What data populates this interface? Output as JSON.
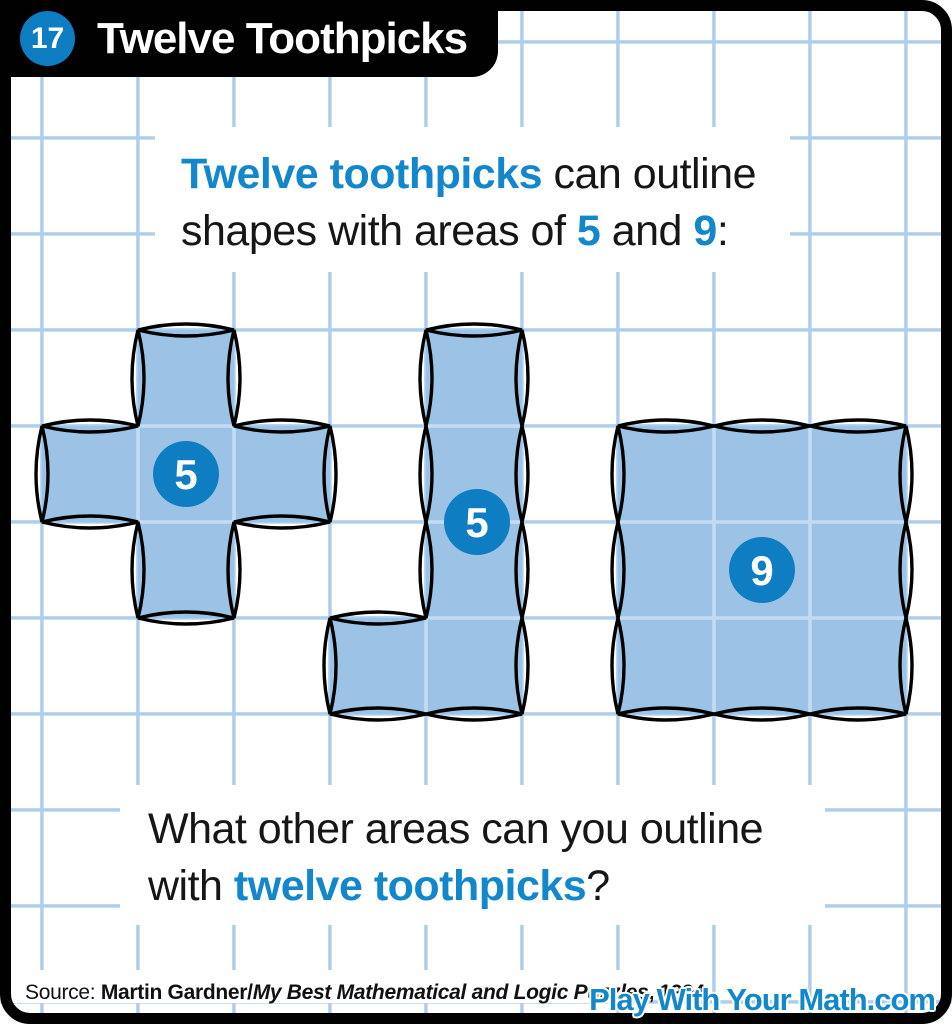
{
  "colors": {
    "accent": "#1287CB",
    "badge": "#0E7DC2",
    "shape_fill": "#9CC3E6",
    "grid_line": "#AFCEEC",
    "inner_line": "#C3DCF4",
    "frame": "#010101"
  },
  "header": {
    "number": "17",
    "title": "Twelve Toothpicks"
  },
  "intro": {
    "lines": [
      [
        {
          "text": "Twelve toothpicks",
          "style": "accent"
        },
        {
          "text": " can outline",
          "style": "plain"
        }
      ],
      [
        {
          "text": "shapes with areas of ",
          "style": "plain"
        },
        {
          "text": "5",
          "style": "accent"
        },
        {
          "text": " and ",
          "style": "plain"
        },
        {
          "text": "9",
          "style": "accent"
        },
        {
          "text": ":",
          "style": "plain"
        }
      ]
    ]
  },
  "question": {
    "lines": [
      [
        {
          "text": "What other areas can you outline",
          "style": "plain"
        }
      ],
      [
        {
          "text": "with ",
          "style": "plain"
        },
        {
          "text": "twelve toothpicks",
          "style": "accent"
        },
        {
          "text": "?",
          "style": "plain"
        }
      ]
    ]
  },
  "grid": {
    "origin": 42,
    "cell": 96
  },
  "shapes": [
    {
      "name": "plus-pentomino",
      "label": "5",
      "cells": [
        [
          1,
          3
        ],
        [
          0,
          4
        ],
        [
          1,
          4
        ],
        [
          2,
          4
        ],
        [
          1,
          5
        ]
      ],
      "badge_center": [
        186,
        474
      ]
    },
    {
      "name": "l-pentomino",
      "label": "5",
      "cells": [
        [
          4,
          3
        ],
        [
          4,
          4
        ],
        [
          4,
          5
        ],
        [
          4,
          6
        ],
        [
          3,
          6
        ]
      ],
      "badge_center": [
        477,
        522
      ]
    },
    {
      "name": "three-by-three-square",
      "label": "9",
      "cells": [
        [
          6,
          4
        ],
        [
          7,
          4
        ],
        [
          8,
          4
        ],
        [
          6,
          5
        ],
        [
          7,
          5
        ],
        [
          8,
          5
        ],
        [
          6,
          6
        ],
        [
          7,
          6
        ],
        [
          8,
          6
        ]
      ],
      "badge_center": [
        762,
        570
      ]
    }
  ],
  "footer": {
    "source_segments": [
      {
        "text": "Source: ",
        "style": "plain"
      },
      {
        "text": "Martin Gardner/",
        "style": "bold"
      },
      {
        "text": "My Best Mathematical and Logic Puzzles",
        "style": "bold-italic"
      },
      {
        "text": ", 1994",
        "style": "bold"
      }
    ],
    "brand": "Play With Your Math.com"
  }
}
